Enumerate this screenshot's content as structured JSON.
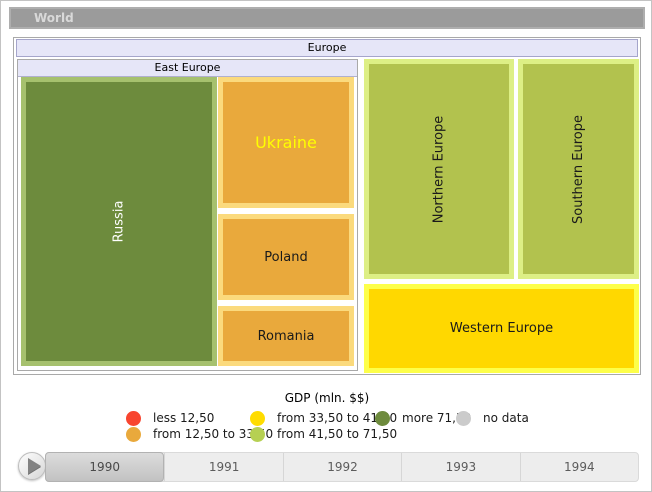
{
  "breadcrumb": {
    "label": "World"
  },
  "treemap": {
    "europe_label": "Europe",
    "east_europe_label": "East Europe",
    "nodes": {
      "russia": {
        "label": "Russia",
        "fill": "#6d8b3d",
        "frame": "#a6c16e",
        "text_color": "#ffffff"
      },
      "ukraine": {
        "label": "Ukraine",
        "fill": "#e9a93c",
        "frame": "#fbda7d",
        "text_color": "#ffff00"
      },
      "poland": {
        "label": "Poland",
        "fill": "#e9a93c",
        "frame": "#fbda7d",
        "text_color": "#1a1a1a"
      },
      "romania": {
        "label": "Romania",
        "fill": "#e9a93c",
        "frame": "#fbda7d",
        "text_color": "#1a1a1a"
      },
      "northern": {
        "label": "Northern Europe",
        "fill": "#b2c24e",
        "frame": "#ddef85",
        "text_color": "#1a1a1a"
      },
      "southern": {
        "label": "Southern Europe",
        "fill": "#b2c24e",
        "frame": "#ddef85",
        "text_color": "#1a1a1a"
      },
      "western": {
        "label": "Western Europe",
        "fill": "#ffd800",
        "frame": "#fdff4a",
        "text_color": "#1a1a1a"
      }
    }
  },
  "legend": {
    "title": "GDP (mln. $$)",
    "items": [
      {
        "label": "less 12,50",
        "color": "#f8452f"
      },
      {
        "label": "from 12,50 to 33,50",
        "color": "#e9a93c"
      },
      {
        "label": "from 33,50 to 41,50",
        "color": "#ffdc00"
      },
      {
        "label": "from 41,50 to 71,50",
        "color": "#b6d053"
      },
      {
        "label": "more 71,50",
        "color": "#6e8b3d"
      },
      {
        "label": "no data",
        "color": "#cbcbcb"
      }
    ]
  },
  "timeline": {
    "selected": "1990",
    "years": [
      "1990",
      "1991",
      "1992",
      "1993",
      "1994"
    ],
    "play_icon": "play-triangle"
  },
  "chart_data": {
    "type": "treemap",
    "title": "GDP (mln. $$)",
    "root": "World",
    "current_view": "Europe",
    "year_shown": "1990",
    "legend_bins": [
      {
        "bin": "less 12,50",
        "color": "#f8452f"
      },
      {
        "bin": "from 12,50 to 33,50",
        "color": "#e9a93c"
      },
      {
        "bin": "from 33,50 to 41,50",
        "color": "#ffdc00"
      },
      {
        "bin": "from 41,50 to 71,50",
        "color": "#b6d053"
      },
      {
        "bin": "more 71,50",
        "color": "#6e8b3d"
      },
      {
        "bin": "no data",
        "color": "#cbcbcb"
      }
    ],
    "nodes": [
      {
        "name": "Europe",
        "parent": "World"
      },
      {
        "name": "East Europe",
        "parent": "Europe"
      },
      {
        "name": "Russia",
        "parent": "East Europe",
        "gdp_bin": "more 71,50"
      },
      {
        "name": "Ukraine",
        "parent": "East Europe",
        "gdp_bin": "from 12,50 to 33,50"
      },
      {
        "name": "Poland",
        "parent": "East Europe",
        "gdp_bin": "from 12,50 to 33,50"
      },
      {
        "name": "Romania",
        "parent": "East Europe",
        "gdp_bin": "from 12,50 to 33,50"
      },
      {
        "name": "Northern Europe",
        "parent": "Europe",
        "gdp_bin": "from 41,50 to 71,50"
      },
      {
        "name": "Southern Europe",
        "parent": "Europe",
        "gdp_bin": "from 41,50 to 71,50"
      },
      {
        "name": "Western Europe",
        "parent": "Europe",
        "gdp_bin": "from 33,50 to 41,50"
      }
    ]
  }
}
